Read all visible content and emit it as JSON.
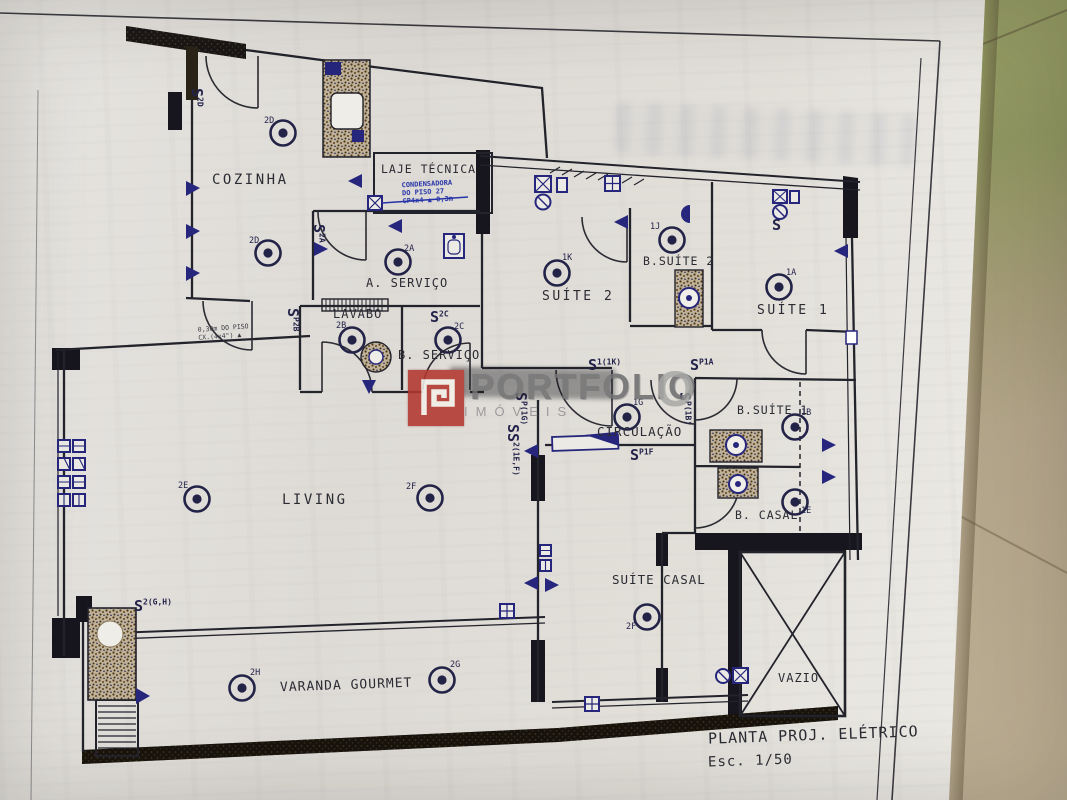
{
  "document": {
    "kind": "electrical project floor plan (photo of printed sheet)",
    "title_block": {
      "title": "PLANTA PROJ. ELÉTRICO",
      "scale": "Esc. 1/50"
    }
  },
  "rooms": [
    {
      "id": "cozinha",
      "label": "COZINHA"
    },
    {
      "id": "laje-tecnica",
      "label": "LAJE TÉCNICA"
    },
    {
      "id": "a-servico",
      "label": "A. SERVIÇO"
    },
    {
      "id": "lavabo",
      "label": "LAVABO"
    },
    {
      "id": "b-servico",
      "label": "B. SERVIÇO"
    },
    {
      "id": "suite-2",
      "label": "SUÍTE 2"
    },
    {
      "id": "b-suite-2",
      "label": "B.SUÍTE 2"
    },
    {
      "id": "suite-1",
      "label": "SUÍTE 1"
    },
    {
      "id": "b-suite-1",
      "label": "B.SUÍTE 1"
    },
    {
      "id": "circulacao",
      "label": "CIRCULAÇÃO"
    },
    {
      "id": "living",
      "label": "LIVING"
    },
    {
      "id": "b-casal",
      "label": "B. CASAL"
    },
    {
      "id": "suite-casal",
      "label": "SUÍTE CASAL"
    },
    {
      "id": "varanda-gourmet",
      "label": "VARANDA GOURMET"
    },
    {
      "id": "vazio",
      "label": "VAZIO"
    }
  ],
  "lights": [
    {
      "id": "cozinha-1",
      "label": "2D"
    },
    {
      "id": "cozinha-2",
      "label": "2D"
    },
    {
      "id": "a-servico",
      "label": "2A"
    },
    {
      "id": "lavabo",
      "label": "2B"
    },
    {
      "id": "b-servico",
      "label": "2C"
    },
    {
      "id": "suite-2",
      "label": "1K"
    },
    {
      "id": "b-suite-2",
      "label": "1J"
    },
    {
      "id": "suite-1",
      "label": "1A"
    },
    {
      "id": "b-suite-1",
      "label": "1B"
    },
    {
      "id": "b-casal",
      "label": "1E"
    },
    {
      "id": "circulacao",
      "label": "1G"
    },
    {
      "id": "living-1",
      "label": "2E"
    },
    {
      "id": "living-2",
      "label": "2F"
    },
    {
      "id": "suite-casal",
      "label": "2F"
    },
    {
      "id": "varanda-1",
      "label": "2H"
    },
    {
      "id": "varanda-2",
      "label": "2G"
    }
  ],
  "switches": [
    {
      "s": "S",
      "sup": "2D"
    },
    {
      "s": "S",
      "sup": "2A"
    },
    {
      "s": "S",
      "sup": "P2B"
    },
    {
      "s": "S",
      "sup": "2C"
    },
    {
      "s": "S",
      "sup": "1(1K)"
    },
    {
      "s": "S",
      "sup": "P(1G)"
    },
    {
      "s": "SS",
      "sup": "2(1E,F)"
    },
    {
      "s": "S",
      "sup": "P1F"
    },
    {
      "s": "S",
      "sup": "P1A"
    },
    {
      "s": "S",
      "sup": "P(1B)"
    },
    {
      "s": "S",
      "sup": "2(G,H)"
    },
    {
      "s": "S",
      "sup": ""
    }
  ],
  "annotations": {
    "condensadora_line1": "CONDENSADORA",
    "condensadora_line2": "DO PISO 27",
    "condensadora_line3": "CP4x4  ▲ 0,3m",
    "floor_note_line1": "0,30m DO PISO",
    "floor_note_line2": "CX.(4x4\") ▲"
  },
  "watermark": {
    "brand": "PORTFOLIO",
    "big_o": "O",
    "subtitle": "IMÓVEIS"
  },
  "symbols_legend": {
    "ceiling-light-icon": "double circle with filled center",
    "wall-outlet-icon": "filled triangle on wall",
    "junction-box-icon": "square with X",
    "window-box-icon": "square with cross",
    "switch-icon": "letter S with circuit superscript",
    "shower-area-icon": "speckled brown area with vent circle"
  },
  "colors": {
    "paper": "#e3e1dd",
    "ink": "#2b2b33",
    "symbol_blue": "#26267c",
    "handwriting_blue": "#2633a8",
    "logo_red": "#b23830",
    "background_wall": "#949a63",
    "background_table": "#b5a78c"
  }
}
